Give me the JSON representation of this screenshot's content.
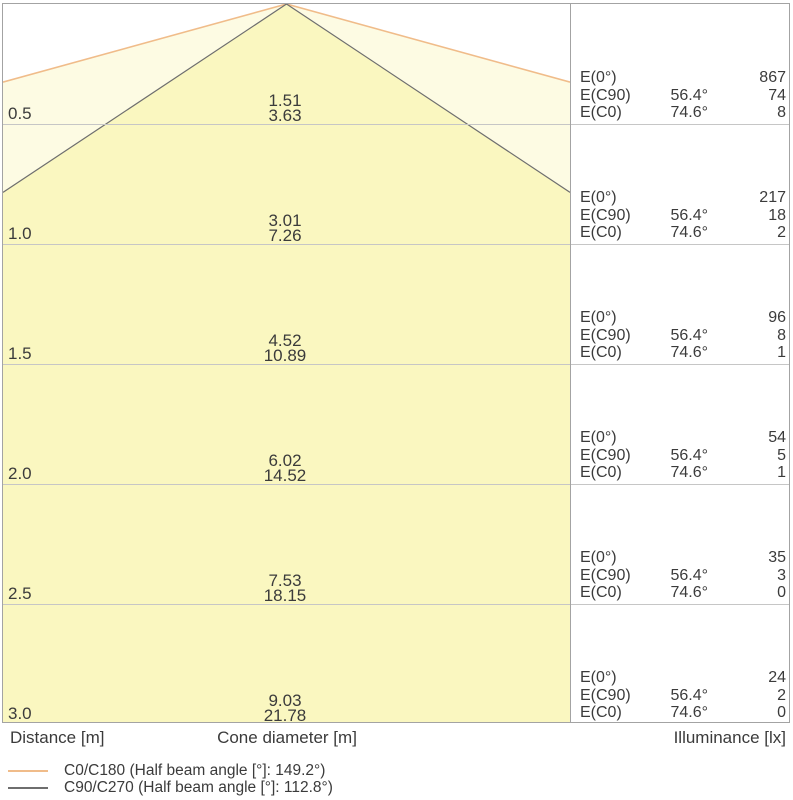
{
  "colors": {
    "cone_outer_fill": "#FDFBE3",
    "cone_inner_fill": "#FAF7C0",
    "c0_line": "#F0BC8A",
    "c90_line": "#6E6E6E",
    "border": "#A3A3A3",
    "row_line": "#C6C6C6",
    "text": "#3B3B3B"
  },
  "labels": {
    "e0": "E(0°)",
    "ec90": "E(C90)",
    "ec0": "E(C0)",
    "angle_c90": "56.4°",
    "angle_c0": "74.6°"
  },
  "axis": {
    "distance": "Distance [m]",
    "cone_diameter": "Cone diameter [m]",
    "illuminance": "Illuminance [lx]"
  },
  "legend": [
    {
      "label": "C0/C180 (Half beam angle [°]: 149.2°)",
      "color": "#F0BC8A"
    },
    {
      "label": "C90/C270 (Half beam angle [°]: 112.8°)",
      "color": "#6E6E6E"
    }
  ],
  "rows": [
    {
      "distance": "0.5",
      "cone_c90": "1.51",
      "cone_c0": "3.63",
      "e0": "867",
      "ec90": "74",
      "ec0": "8"
    },
    {
      "distance": "1.0",
      "cone_c90": "3.01",
      "cone_c0": "7.26",
      "e0": "217",
      "ec90": "18",
      "ec0": "2"
    },
    {
      "distance": "1.5",
      "cone_c90": "4.52",
      "cone_c0": "10.89",
      "e0": "96",
      "ec90": "8",
      "ec0": "1"
    },
    {
      "distance": "2.0",
      "cone_c90": "6.02",
      "cone_c0": "14.52",
      "e0": "54",
      "ec90": "5",
      "ec0": "1"
    },
    {
      "distance": "2.5",
      "cone_c90": "7.53",
      "cone_c0": "18.15",
      "e0": "35",
      "ec90": "3",
      "ec0": "0"
    },
    {
      "distance": "3.0",
      "cone_c90": "9.03",
      "cone_c0": "21.78",
      "e0": "24",
      "ec90": "2",
      "ec0": "0"
    }
  ],
  "chart_data": {
    "type": "table",
    "title": "Luminous cone diagram with illuminance table",
    "distances_m": [
      0.5,
      1.0,
      1.5,
      2.0,
      2.5,
      3.0
    ],
    "series": [
      {
        "name": "C0/C180",
        "half_beam_angle_deg": 149.2,
        "cone_diameters_m": [
          3.63,
          7.26,
          10.89,
          14.52,
          18.15,
          21.78
        ],
        "color": "#F0BC8A"
      },
      {
        "name": "C90/C270",
        "half_beam_angle_deg": 112.8,
        "cone_diameters_m": [
          1.51,
          3.01,
          4.52,
          6.02,
          7.53,
          9.03
        ],
        "color": "#6E6E6E"
      }
    ],
    "illuminance_lx": [
      {
        "name": "E(0°)",
        "angle": null,
        "values": [
          867,
          217,
          96,
          54,
          35,
          24
        ]
      },
      {
        "name": "E(C90)",
        "angle": "56.4°",
        "values": [
          74,
          18,
          8,
          5,
          3,
          2
        ]
      },
      {
        "name": "E(C0)",
        "angle": "74.6°",
        "values": [
          8,
          2,
          1,
          1,
          0,
          0
        ]
      }
    ],
    "xlabel": "Distance [m]",
    "ylabel": "Illuminance [lx]",
    "layout": {
      "row_spacing_m": 0.5,
      "scale_px_per_m": 240,
      "legend_position": "bottom-left"
    }
  }
}
